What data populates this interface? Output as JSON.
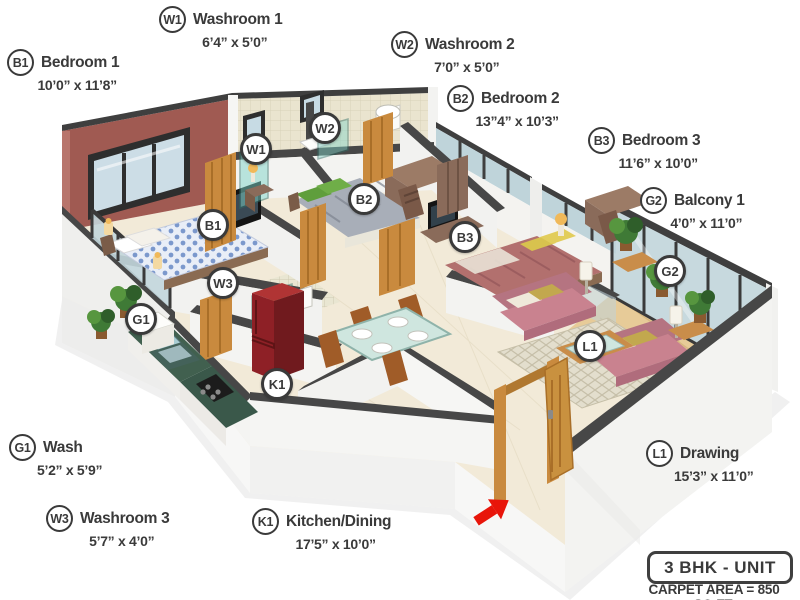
{
  "unit": {
    "type_label": "3 BHK - UNIT",
    "carpet_area_label": "CARPET AREA = 850 SQ.FT."
  },
  "rooms": [
    {
      "code": "B1",
      "name": "Bedroom 1",
      "dims": "10’0” x 11’8”"
    },
    {
      "code": "W1",
      "name": "Washroom 1",
      "dims": "6’4” x 5’0”"
    },
    {
      "code": "W2",
      "name": "Washroom 2",
      "dims": "7’0” x 5’0”"
    },
    {
      "code": "B2",
      "name": "Bedroom 2",
      "dims": "13”4” x 10’3”"
    },
    {
      "code": "B3",
      "name": "Bedroom 3",
      "dims": "11’6” x 10’0”"
    },
    {
      "code": "G2",
      "name": "Balcony 1",
      "dims": "4’0” x 11’0”"
    },
    {
      "code": "G1",
      "name": "Wash",
      "dims": "5’2” x 5’9”"
    },
    {
      "code": "W3",
      "name": "Washroom 3",
      "dims": "5’7” x 4’0”"
    },
    {
      "code": "K1",
      "name": "Kitchen/Dining",
      "dims": "17’5” x 10’0”"
    },
    {
      "code": "L1",
      "name": "Drawing",
      "dims": "15’3” x 11’0”"
    }
  ],
  "colors": {
    "accent_wall_maroon": "#a05a52",
    "tile_wall_beige": "#eae4cf",
    "floor_cream": "#f2ead8",
    "wall_cap_gray": "#474747",
    "wood_orange": "#c98a3e",
    "fridge_red": "#8e2026",
    "counter_green": "#41604f",
    "sofa_pink": "#c9828f",
    "bed1_blue": "#7b98cc",
    "bed2_gray": "#a8aeb8",
    "bed3_pink": "#b2706e",
    "pillow_green": "#5f9e3c",
    "glass_blue": "#bfd4da",
    "arrow_red": "#e8150a",
    "label_ink": "#3a3a3a"
  }
}
